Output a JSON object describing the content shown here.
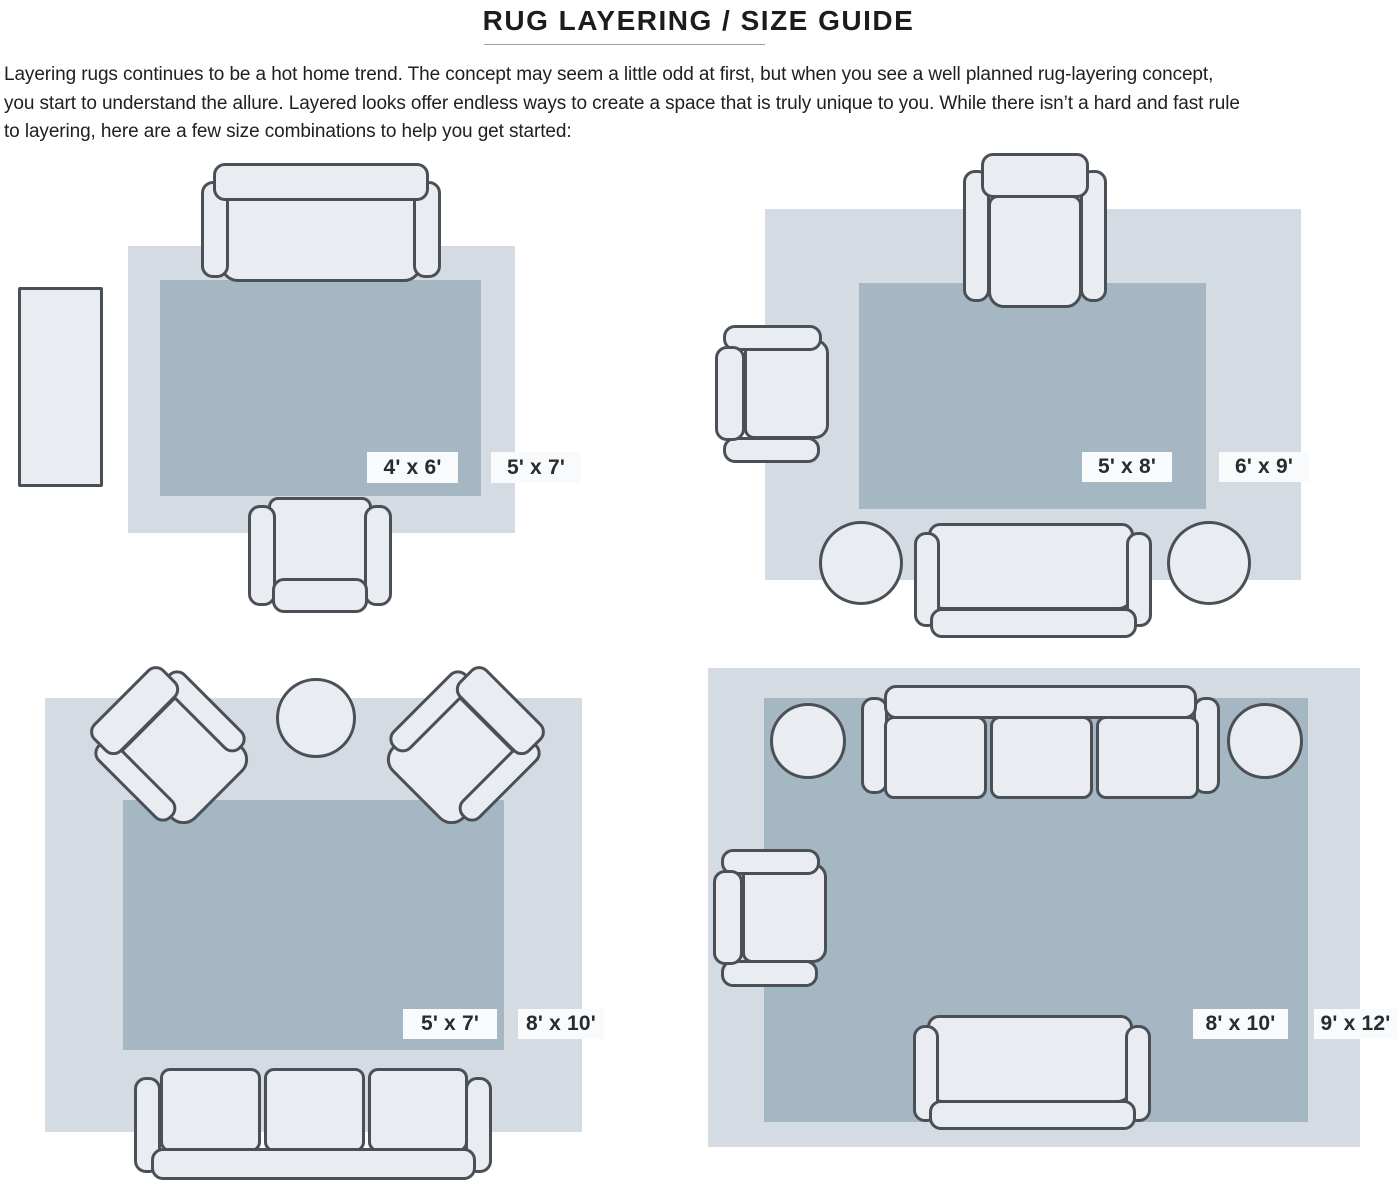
{
  "title": "RUG LAYERING / SIZE GUIDE",
  "intro": {
    "line1": "Layering rugs continues to be a hot home trend. The concept may seem a little odd at first, but when you see a well planned rug-layering concept,",
    "line2": "you start to understand the allure. Layered looks offer endless ways to create a space that is truly unique to you. While there isn’t a hard and fast rule",
    "line3": "to layering, here are a few size combinations to help you get started:"
  },
  "colors": {
    "page_bg": "#ffffff",
    "rug_light": "#d4dbe3",
    "rug_dark": "#a6b7c4",
    "furniture_fill": "#e9edf1",
    "furniture_stroke": "#4b5056",
    "label_bg": "#f8fafb",
    "label_text": "#292b2d",
    "title_text": "#1c1c1e",
    "body_text": "#202022",
    "rule_color": "#9b9fa3"
  },
  "diagrams": [
    {
      "position": "top-left",
      "inner_label": "4' x 6'",
      "outer_label": "5' x 7'",
      "furniture": [
        "sofa",
        "armchair",
        "side-table"
      ]
    },
    {
      "position": "top-right",
      "inner_label": "5' x 8'",
      "outer_label": "6' x 9'",
      "furniture": [
        "armchair",
        "armchair",
        "sofa",
        "round-side-table",
        "round-side-table"
      ]
    },
    {
      "position": "bottom-left",
      "inner_label": "5' x 7'",
      "outer_label": "8' x 10'",
      "furniture": [
        "angled-armchair",
        "angled-armchair",
        "round-table",
        "three-seat-sofa"
      ]
    },
    {
      "position": "bottom-right",
      "inner_label": "8' x 10'",
      "outer_label": "9' x 12'",
      "furniture": [
        "three-seat-sofa",
        "round-side-table",
        "round-side-table",
        "armchair",
        "loveseat"
      ]
    }
  ]
}
